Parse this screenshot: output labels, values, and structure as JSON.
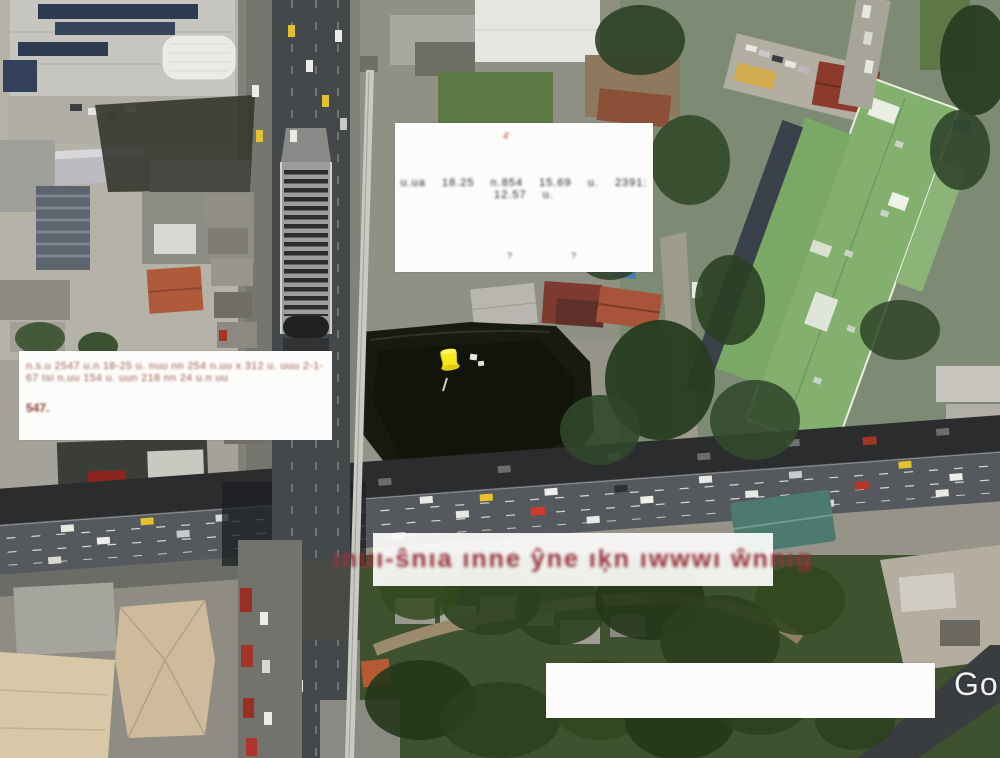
{
  "view": {
    "type": "satellite-map",
    "watermark": "Go"
  },
  "pin": {
    "kind": "yellow-pushpin"
  },
  "annotations": {
    "top_box": {
      "red_mark": "4'",
      "blurred_row": "u.ua 18.25  n.854  15.69 u.  2391:  12.57 u.",
      "footnote_left": "?",
      "footnote_right": "?"
    },
    "left_box": {
      "blurred_line": "n.s.u 2547 u.n 18-25 u. nuu nn 254 n.uu x 312 u. uuu 2-1-67 tsi n.uu 154 u. uun 218 nn 24 u.n uu",
      "blurred_word": "547."
    },
    "red_banner": {
      "blurred_text": "ınuı-ŝnıa ınne ŷne ıķn ıwwwı ŵnnıg"
    },
    "bottom_box": {
      "text": ""
    }
  },
  "colors": {
    "banner_text": "#96333b",
    "annotation_bg": "#fcfcfa",
    "pin_yellow": "#f5e51a",
    "watermark_white": "#ffffff",
    "pond_dark": "#171a10",
    "green_roof": "#83b06f"
  }
}
